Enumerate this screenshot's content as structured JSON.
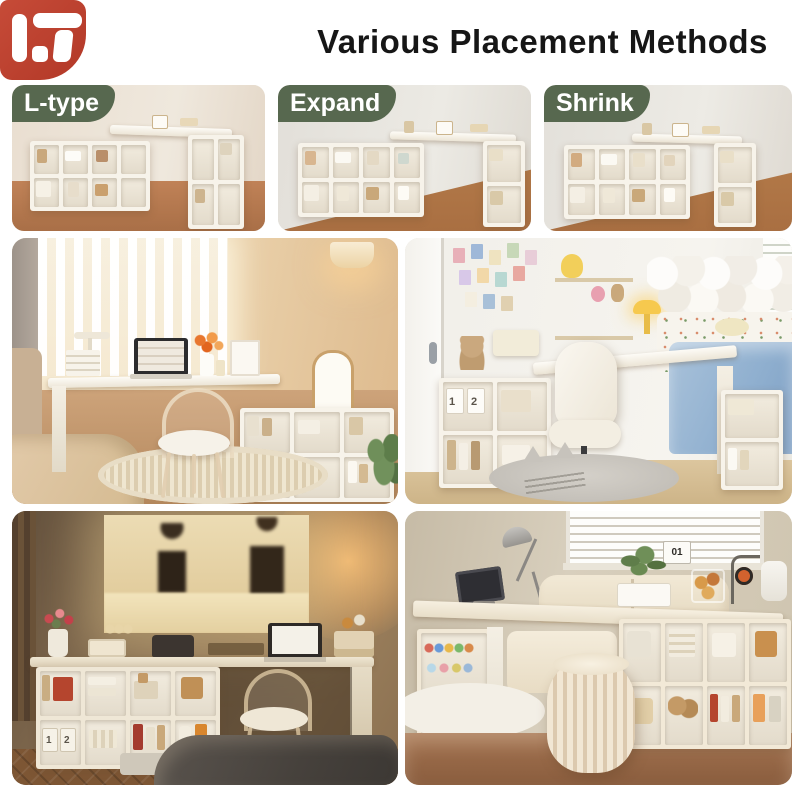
{
  "header": {
    "title": "Various Placement Methods",
    "logo_name": "brand-monogram-IT",
    "logo_color": "#bc4233"
  },
  "badge": {
    "bg": "#57684f",
    "text_color": "#ffffff"
  },
  "placements": [
    {
      "label": "L-type"
    },
    {
      "label": "Expand"
    },
    {
      "label": "Shrink"
    }
  ],
  "photos": {
    "top_row": [
      "l-type-configuration",
      "expand-configuration",
      "shrink-configuration"
    ],
    "middle_left": "warm-bedroom-corner-desk-ghost-chair",
    "middle_right": "bright-bedroom-desk-beside-bed",
    "bottom_left": "night-desk-with-wall-projection",
    "bottom_right": "living-room-desk-behind-sofa"
  },
  "labels": {
    "calendar_day": "01",
    "box_number_1": "1",
    "box_number_2": "2"
  }
}
